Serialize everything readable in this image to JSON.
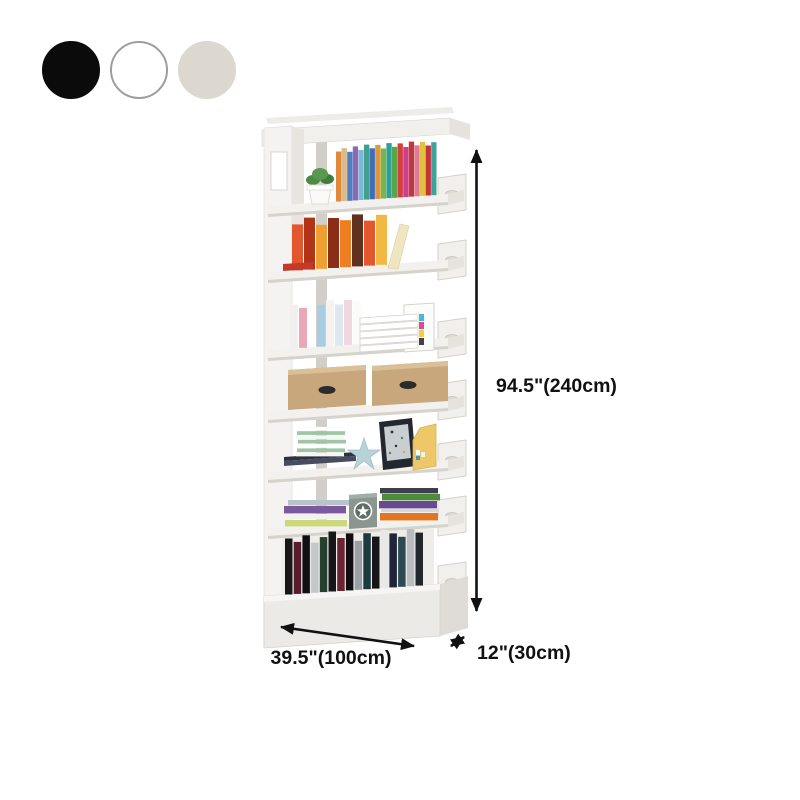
{
  "swatches": [
    {
      "name": "black",
      "color": "#0b0b0b",
      "border": "#0b0b0b"
    },
    {
      "name": "white",
      "color": "#ffffff",
      "border": "#9d9d9d"
    },
    {
      "name": "cream",
      "color": "#dcd8cf",
      "border": "#dcd8cf"
    }
  ],
  "dimensions": {
    "height": "94.5\"(240cm)",
    "width": "39.5\"(100cm)",
    "depth": "12\"(30cm)"
  },
  "palette": {
    "annotation": "#111111",
    "shelf_face": "#f3f1ee",
    "shelf_side": "#e6e2dd",
    "shelf_edge": "#d6d2cc",
    "back_post": "#d2cfca",
    "kraft": "#c8a77c",
    "kraft_top": "#dabf97",
    "handle_dark": "#2b2b2b",
    "star_blue": "#b7d3d8",
    "file_yellow": "#eec868",
    "frame_dark": "#23272e",
    "frame_screen": "#c9ced3",
    "plant_green": "#4e8a44",
    "pot_white": "#fafaf8",
    "star_box": "#8a968f",
    "star_box_disc": "#5f6d66",
    "lean_book": "#efe6c0",
    "flat_red_book": "#c23a2a"
  },
  "items": {
    "rainbow_books": [
      {
        "c": "#e08a3c",
        "h": 50
      },
      {
        "c": "#d8bc8e",
        "h": 53
      },
      {
        "c": "#4f7fc0",
        "h": 49
      },
      {
        "c": "#8a68b4",
        "h": 54
      },
      {
        "c": "#7fb5d8",
        "h": 50
      },
      {
        "c": "#3fa18d",
        "h": 55
      },
      {
        "c": "#3f6db8",
        "h": 51
      },
      {
        "c": "#e0963c",
        "h": 54
      },
      {
        "c": "#7bb449",
        "h": 50
      },
      {
        "c": "#2f9f9b",
        "h": 55
      },
      {
        "c": "#57a648",
        "h": 51
      },
      {
        "c": "#d24040",
        "h": 54
      },
      {
        "c": "#cc3f8d",
        "h": 50
      },
      {
        "c": "#bc3a3a",
        "h": 55
      },
      {
        "c": "#e07a98",
        "h": 51
      },
      {
        "c": "#e0c23f",
        "h": 54
      },
      {
        "c": "#c2333c",
        "h": 50
      },
      {
        "c": "#3fa19b",
        "h": 53
      }
    ],
    "warm_books": [
      {
        "c": "#e2572e",
        "h": 46
      },
      {
        "c": "#b23418",
        "h": 52
      },
      {
        "c": "#f0a032",
        "h": 44
      },
      {
        "c": "#8a2f16",
        "h": 50
      },
      {
        "c": "#ef7d22",
        "h": 47
      },
      {
        "c": "#5f3020",
        "h": 52
      },
      {
        "c": "#e2572e",
        "h": 45
      },
      {
        "c": "#f2b843",
        "h": 50
      }
    ],
    "pastel_books": [
      {
        "c": "#f2f0ee",
        "h": 44
      },
      {
        "c": "#e8a8b8",
        "h": 40
      },
      {
        "c": "#ffffff",
        "h": 47
      },
      {
        "c": "#a8cce0",
        "h": 42
      },
      {
        "c": "#f5f3f0",
        "h": 46
      },
      {
        "c": "#dfe7ef",
        "h": 41
      },
      {
        "c": "#f0d8e0",
        "h": 45
      },
      {
        "c": "#fbfbfa",
        "h": 43
      }
    ],
    "notebook_stack": [
      {
        "c": "#f5f7f4",
        "h": 4.3
      },
      {
        "c": "#9fc4a6",
        "h": 4.3,
        "dx": 1
      },
      {
        "c": "#ffffff",
        "h": 4.3
      },
      {
        "c": "#9fc4a6",
        "h": 4.3,
        "dx": 2
      },
      {
        "c": "#f5f7f4",
        "h": 4.3
      },
      {
        "c": "#9fc4a6",
        "h": 4.3,
        "dx": 1
      },
      {
        "c": "#ffffff",
        "h": 4.3
      }
    ],
    "flat_stack_left": [
      {
        "c": "#ccd87c",
        "h": 7
      },
      {
        "c": "#f2f2ee",
        "h": 6,
        "dx": 2
      },
      {
        "c": "#7a5a9c",
        "h": 8,
        "dx": -1
      },
      {
        "c": "#b9c4c9",
        "h": 6,
        "dx": 3
      }
    ],
    "flat_stack_right": [
      {
        "c": "#e2761f",
        "h": 8
      },
      {
        "c": "#d8d8d4",
        "h": 4,
        "dx": 1
      },
      {
        "c": "#6a4a8e",
        "h": 8,
        "dx": -1
      },
      {
        "c": "#4f8a3c",
        "h": 7,
        "dx": 2
      },
      {
        "c": "#3a3f4a",
        "h": 6
      }
    ],
    "media_books": [
      {
        "c": "#17171a",
        "h": 56
      },
      {
        "c": "#571d2c",
        "h": 52
      },
      {
        "c": "#101013",
        "h": 58
      },
      {
        "c": "#c4c6c8",
        "h": 50
      },
      {
        "c": "#25402f",
        "h": 55
      },
      {
        "c": "#17171a",
        "h": 60
      },
      {
        "c": "#6b2333",
        "h": 53
      },
      {
        "c": "#0f0f12",
        "h": 57
      },
      {
        "c": "#9aa0a6",
        "h": 49
      },
      {
        "c": "#1d3a3f",
        "h": 56
      },
      {
        "c": "#17171a",
        "h": 52
      },
      {
        "c": "#e8e8e6",
        "h": 58
      },
      {
        "c": "#20243a",
        "h": 54
      },
      {
        "c": "#2c4a50",
        "h": 50
      },
      {
        "c": "#b9bcc0",
        "h": 57
      },
      {
        "c": "#23262b",
        "h": 53
      }
    ]
  }
}
